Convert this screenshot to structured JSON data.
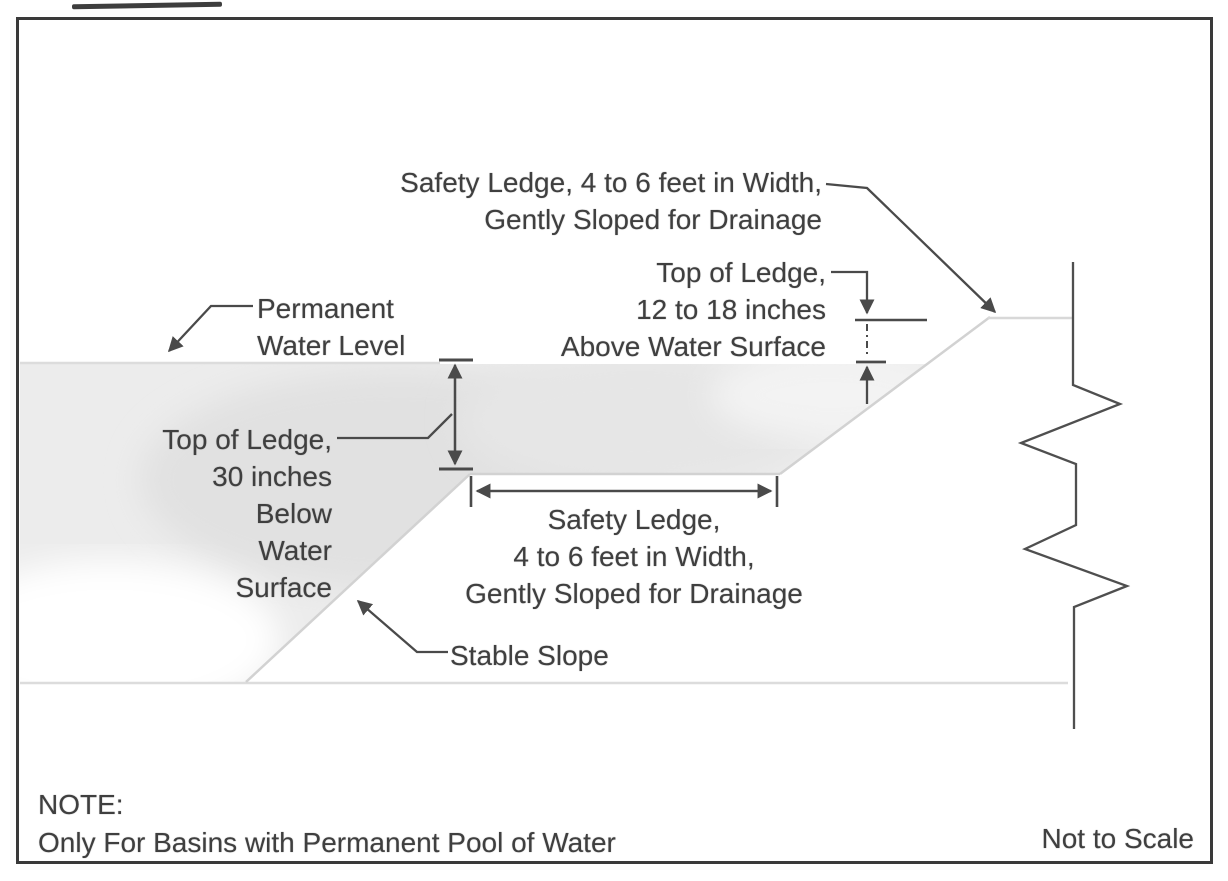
{
  "diagram": {
    "labels": {
      "safety_ledge_top": {
        "lines": [
          "Safety Ledge, 4 to 6 feet in Width,",
          "Gently Sloped for Drainage"
        ]
      },
      "top_of_ledge_above_water": {
        "lines": [
          "Top of Ledge,",
          "12 to 18 inches",
          "Above Water Surface"
        ]
      },
      "permanent_water_level": {
        "lines": [
          "Permanent",
          "Water Level"
        ]
      },
      "top_of_ledge_below_water": {
        "lines": [
          "Top of Ledge,",
          "30 inches",
          "Below",
          "Water",
          "Surface"
        ]
      },
      "safety_ledge_center": {
        "lines": [
          "Safety Ledge,",
          "4 to 6 feet in Width,",
          "Gently Sloped for Drainage"
        ]
      },
      "stable_slope": {
        "lines": [
          "Stable Slope"
        ]
      }
    },
    "note": {
      "heading": "NOTE:",
      "body": "Only For Basins with Permanent Pool of Water"
    },
    "scale_label": "Not to Scale",
    "dimensions_noted": {
      "ledge_width": "4 to 6 feet",
      "ledge_above_water": "12 to 18 inches",
      "ledge_below_water": "30 inches"
    },
    "colors": {
      "text": "#3f3f3f",
      "line": "#4a4a4a",
      "faint_line": "#d6d6d6",
      "water_fill": "#ececec",
      "border": "#3a3a3a",
      "background": "#ffffff"
    }
  }
}
